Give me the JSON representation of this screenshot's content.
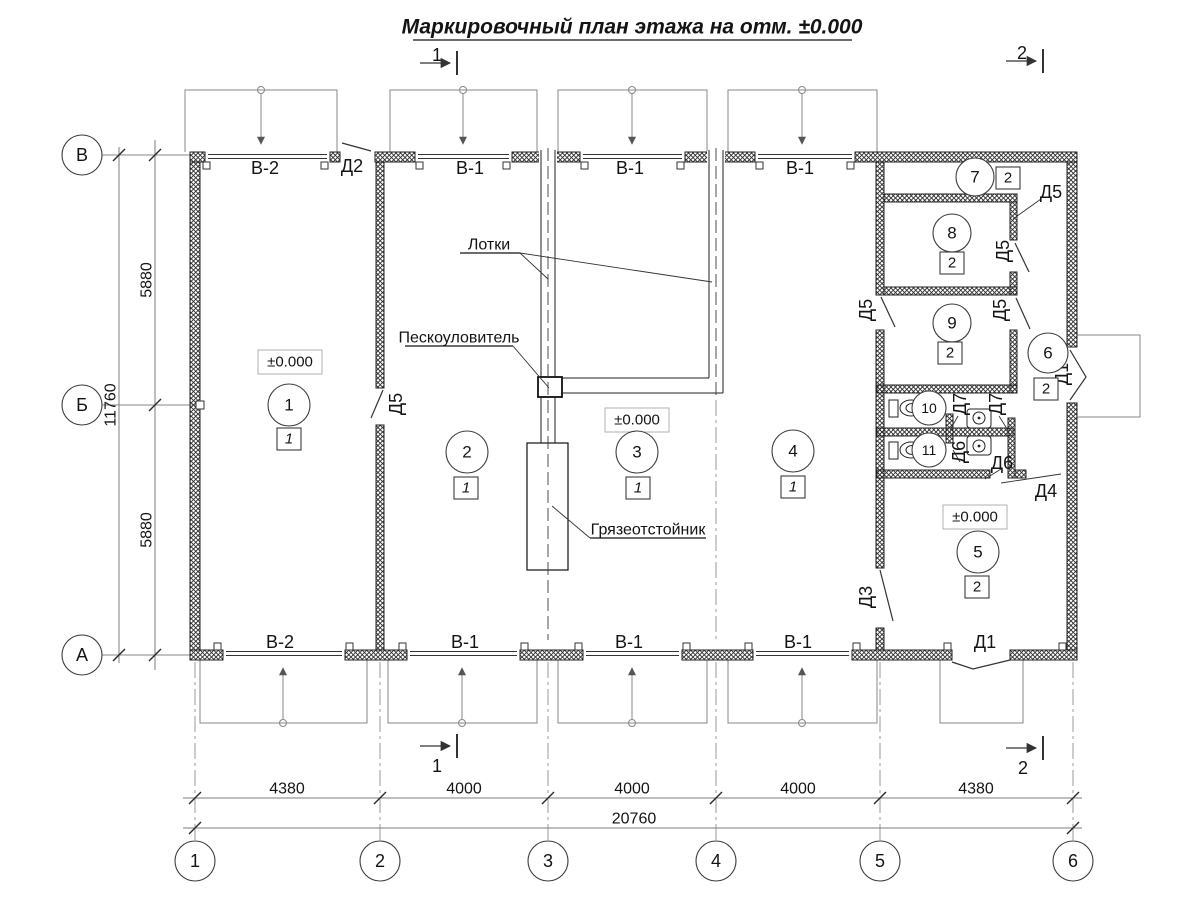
{
  "title": "Маркировочный план этажа на отм. ±0.000",
  "elevation_mark": "±0.000",
  "section_marks": {
    "one": "1",
    "two": "2"
  },
  "axes": {
    "rows": [
      "В",
      "Б",
      "А"
    ],
    "cols": [
      "1",
      "2",
      "3",
      "4",
      "5",
      "6"
    ]
  },
  "dims": {
    "left_top": "5880",
    "left_bottom": "5880",
    "left_total": "11760",
    "bottom": [
      "4380",
      "4000",
      "4000",
      "4000",
      "4380"
    ],
    "bottom_total": "20760"
  },
  "gates": {
    "top": [
      "В-2",
      "В-1",
      "В-1",
      "В-1"
    ],
    "bottom": [
      "В-2",
      "В-1",
      "В-1",
      "В-1"
    ]
  },
  "doors": {
    "d1_bottom": "Д1",
    "d1_right": "Д1",
    "d2": "Д2",
    "d3": "Д3",
    "d4": "Д4",
    "d5_room1": "Д5",
    "d5_room7": "Д5",
    "d5_room8": "Д5",
    "d5_room4": "Д5",
    "d5_room9": "Д5",
    "d6_upper": "Д6",
    "d6_lower": "Д6",
    "d7_left": "Д7",
    "d7_right": "Д7"
  },
  "annotations": {
    "trays": "Лотки",
    "sand_trap": "Пескоуловитель",
    "mud_trap": "Грязеотстойник"
  },
  "rooms": [
    {
      "number": "1",
      "category": "1"
    },
    {
      "number": "2",
      "category": "1"
    },
    {
      "number": "3",
      "category": "1"
    },
    {
      "number": "4",
      "category": "1"
    },
    {
      "number": "5",
      "category": "2"
    },
    {
      "number": "6",
      "category": "2"
    },
    {
      "number": "7",
      "category": "2"
    },
    {
      "number": "8",
      "category": "2"
    },
    {
      "number": "9",
      "category": "2"
    },
    {
      "number": "10"
    },
    {
      "number": "11"
    }
  ]
}
